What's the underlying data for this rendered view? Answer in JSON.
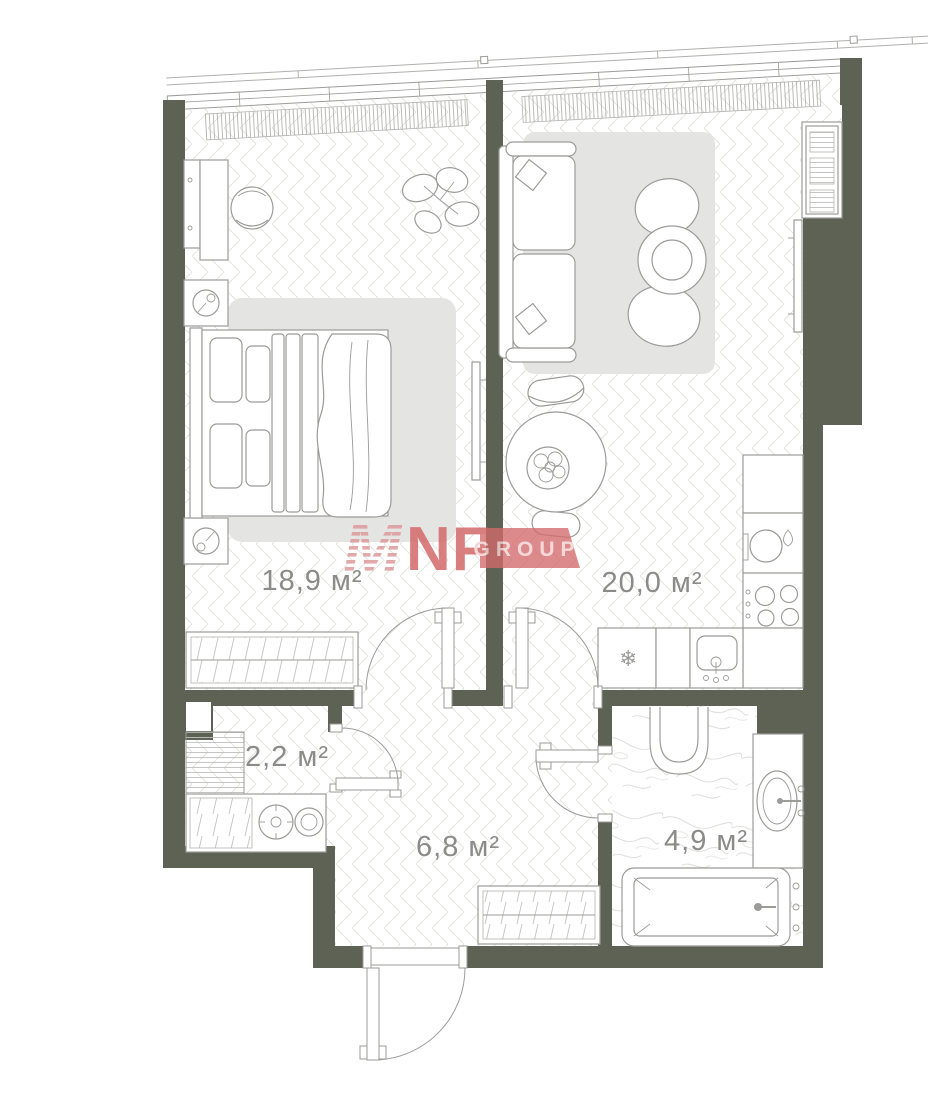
{
  "colors": {
    "wall": "#5e6255",
    "line": "#9b9b98",
    "floor-line": "#e3e3e0",
    "hatch": "#b3b3b0",
    "rug": "#e4e5e3",
    "label": "#8b8b89",
    "brand": "#d4696b",
    "brand-stripe": "#dd9b9c",
    "brand-text": "#f2d4d3"
  },
  "plan": {
    "rooms": [
      {
        "id": "bedroom",
        "area_label": "18,9 м²"
      },
      {
        "id": "living-kitchen",
        "area_label": "20,0 м²"
      },
      {
        "id": "storage",
        "area_label": "2,2 м²"
      },
      {
        "id": "hallway",
        "area_label": "6,8 м²"
      },
      {
        "id": "bathroom",
        "area_label": "4,9 м²"
      }
    ]
  },
  "logo": {
    "mark": "M",
    "name": "NF",
    "suffix": "GROUP"
  },
  "icons": {
    "freezer": "❄"
  }
}
